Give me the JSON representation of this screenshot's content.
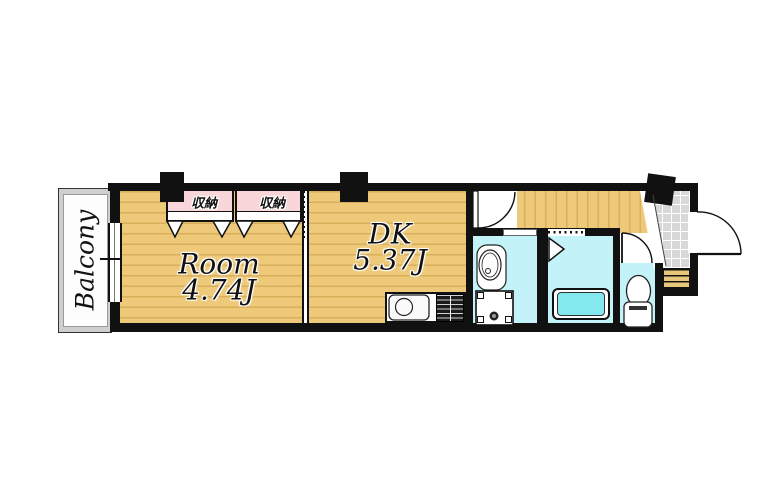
{
  "floorplan": {
    "balcony": {
      "label": "Balcony"
    },
    "room": {
      "name": "Room",
      "area": "4.74J"
    },
    "dk": {
      "name": "DK",
      "area": "5.37J"
    },
    "closets": [
      {
        "label": "収納"
      },
      {
        "label": "収納"
      }
    ],
    "colors": {
      "wall": "#111111",
      "floor": "#eec979",
      "floor_stripe": "#d8b05c",
      "water": "#c3f2f8",
      "tub": "#84e9ee",
      "closet": "#f8d6da",
      "tile": "#d8d8d8",
      "balcony": "#cfcfcf",
      "steps": "#e7c87a"
    }
  }
}
